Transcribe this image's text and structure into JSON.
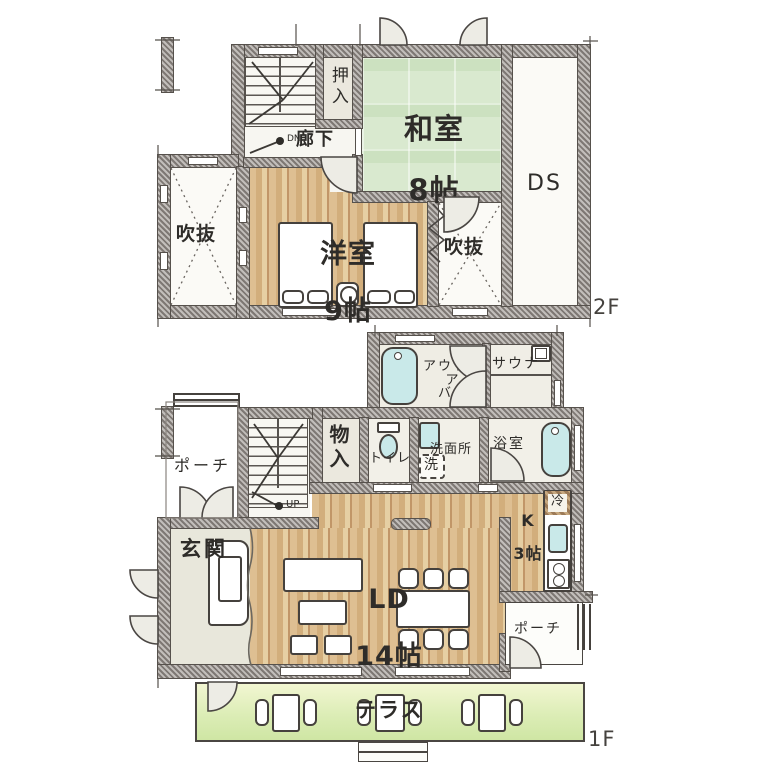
{
  "plan_title": "two-story house floor plan",
  "colors": {
    "wall": "#a8a29d",
    "tatami_green": "#d9e9cf",
    "wood_floor": "#d2ae7c",
    "bath_water": "#c9e9e9",
    "terrace_green": "#dcedb6",
    "room_white": "#f2f0e8",
    "ink": "#2e2c29"
  },
  "floors": [
    {
      "label": "2F",
      "rooms": {
        "washitsu": {
          "name": "和室",
          "size": "8帖"
        },
        "yoshitsu": {
          "name": "洋室",
          "size": "9帖"
        },
        "oshiire": "押入",
        "rouka": "廊下",
        "dn": "DN",
        "ds": "DS",
        "fukinuke_left": "吹抜",
        "fukinuke_right": "吹抜"
      }
    },
    {
      "label": "1F",
      "rooms": {
        "porch_left": "ポーチ",
        "porch_right": "ポーチ",
        "genkan": "玄関",
        "monoire": "物入",
        "toilet": "トイレ",
        "senmenjo": "洗面所",
        "washer": "洗",
        "yokushitsu": "浴室",
        "outdoor_bath": "アウトドア\nバス",
        "sauna": "サウナ",
        "kitchen": {
          "name": "K",
          "size": "3帖"
        },
        "fridge": "冷",
        "ld": {
          "name": "LD",
          "size": "14帖"
        },
        "terrace": "テラス",
        "up": "UP"
      }
    }
  ]
}
